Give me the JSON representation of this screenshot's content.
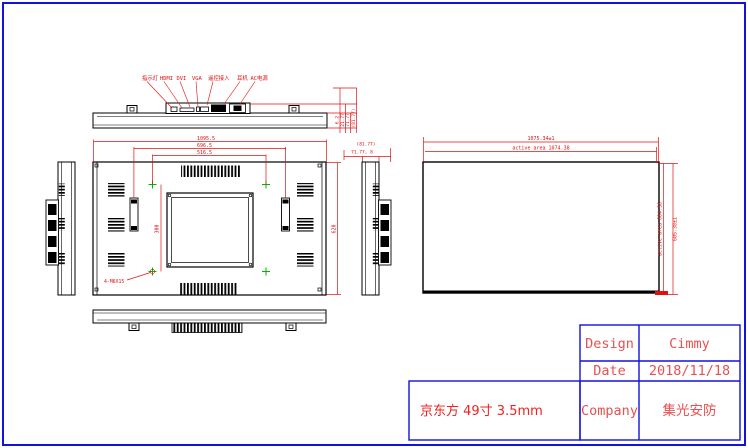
{
  "colors": {
    "line": "#000000",
    "dim_red": "#e01010",
    "green_mark": "#00b400",
    "border_blue": "#1212dc",
    "title_red": "#e85050",
    "product_red": "#ee2222"
  },
  "ports": {
    "labels": [
      "指示灯",
      "HDMI",
      "DVI",
      "VGA",
      "遥控接入",
      "耳机",
      "AC电源"
    ]
  },
  "top_view": {
    "depth_dims": [
      "6.2",
      "21.77",
      "71.77",
      "(81.77)"
    ]
  },
  "side_view": {
    "total_depth": "(81.77)",
    "sub_depth": "71.77, 8"
  },
  "back_view": {
    "overall_width": "1095.5",
    "bracket_span": "696.5",
    "vesa_span": "516.5",
    "overall_height": "620",
    "vesa_height": "300",
    "screw_spec": "4-M6X15"
  },
  "panel_view": {
    "outline_width": "1075.34±1",
    "active_width": "active area 1074.38",
    "outline_height": "605.38±1",
    "active_height": "active area 604.38"
  },
  "title_block": {
    "design_label": "Design",
    "design_value": "Cimmy",
    "date_label": "Date",
    "date_value": "2018/11/18",
    "company_label": "Company",
    "company_value": "集光安防",
    "product": "京东方 49寸 3.5mm"
  }
}
